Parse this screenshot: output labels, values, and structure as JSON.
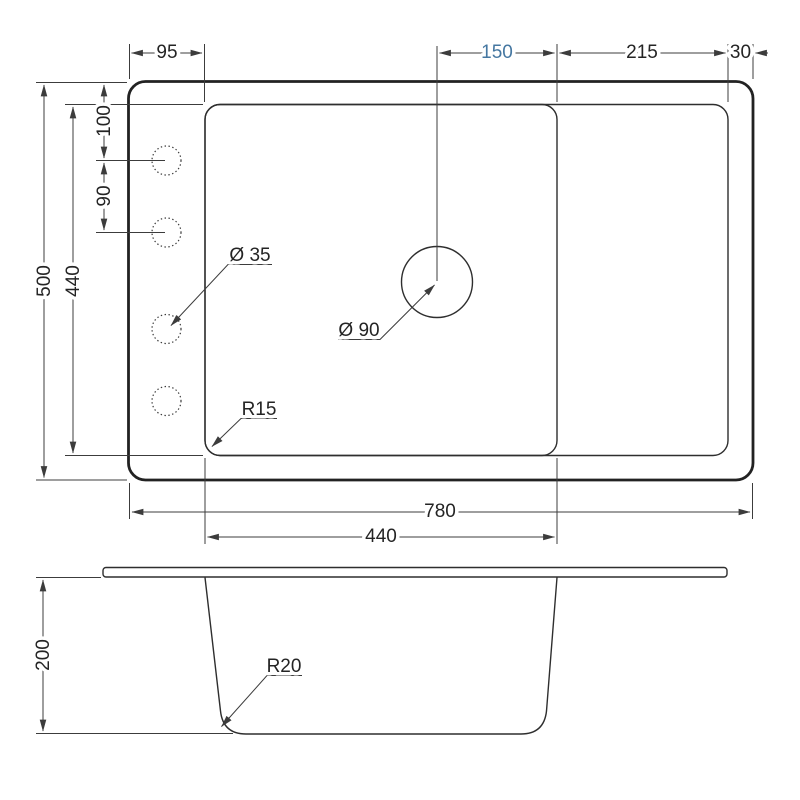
{
  "colors": {
    "line": "#222222",
    "dim_line": "#3c3c3c",
    "accent_blue": "#4577a1",
    "background": "#ffffff"
  },
  "plan_view": {
    "top_dims": {
      "rim_to_bowl_left": "95",
      "drain_to_divider": "150",
      "drainboard_width": "215",
      "right_rim": "30"
    },
    "left_dims": {
      "overall_depth": "500",
      "inner_depth": "440",
      "hole_top_offset": "100",
      "hole_spacing": "90"
    },
    "bottom_dims": {
      "overall_width": "780",
      "bowl_width": "440"
    },
    "labels": {
      "faucet_hole_diameter": "Ø 35",
      "drain_diameter": "Ø 90",
      "bowl_corner_radius": "R15"
    }
  },
  "section_view": {
    "dims": {
      "bowl_depth": "200"
    },
    "labels": {
      "bottom_corner_radius": "R20"
    }
  }
}
